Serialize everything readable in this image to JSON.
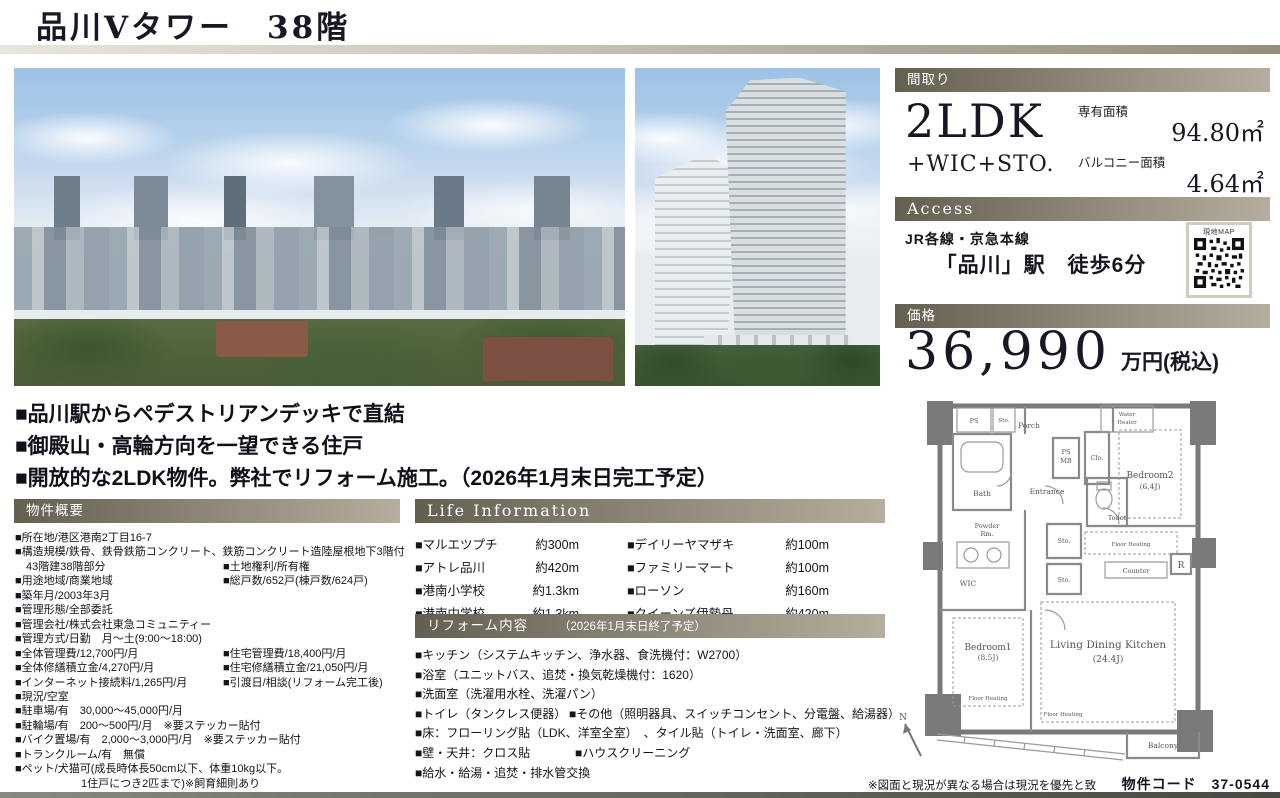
{
  "page": {
    "title": "品川Vタワー　38階",
    "footer_note": "※図面と現況が異なる場合は現況を優先と致します。",
    "property_code": "物件コード　37-0544"
  },
  "colors": {
    "accent_bar_left": "#655f52",
    "accent_bar_right": "#b5ae9f",
    "title_color": "#181824"
  },
  "madori": {
    "header": "間取り",
    "layout": "2LDK",
    "layout_sub": "+WIC+STO.",
    "exclusive_area_label": "専有面積",
    "exclusive_area": "94.80㎡",
    "balcony_area_label": "バルコニー面積",
    "balcony_area": "4.64㎡"
  },
  "access": {
    "header": "Access",
    "rail_lines": "JR各線・京急本線",
    "station": "「品川」駅　徒歩6分",
    "map_label": "現地MAP"
  },
  "price": {
    "header": "価格",
    "amount": "36,990",
    "unit": "万円(税込)"
  },
  "highlights": [
    "■品川駅からペデストリアンデッキで直結",
    "■御殿山・高輪方向を一望できる住戸",
    "■開放的な2LDK物件。弊社でリフォーム施工。（2026年1月末日完工予定）"
  ],
  "overview": {
    "header": "物件概要",
    "rows": [
      {
        "left": "■所在地/港区港南2丁目16-7",
        "right": ""
      },
      {
        "left": "■構造規模/鉄骨、鉄骨鉄筋コンクリート、鉄筋コンクリート造陸屋根地下3階付",
        "right": ""
      },
      {
        "left": "　43階建38階部分",
        "right": "■土地権利/所有権"
      },
      {
        "left": "■用途地域/商業地域",
        "right": "■総戸数/652戸(棟戸数/624戸)"
      },
      {
        "left": "■築年月/2003年3月",
        "right": ""
      },
      {
        "left": "■管理形態/全部委託",
        "right": ""
      },
      {
        "left": "■管理会社/株式会社東急コミュニティー",
        "right": ""
      },
      {
        "left": "■管理方式/日勤　月～土(9:00～18:00)",
        "right": ""
      },
      {
        "left": "■全体管理費/12,700円/月",
        "right": "■住宅管理費/18,400円/月"
      },
      {
        "left": "■全体修繕積立金/4,270円/月",
        "right": "■住宅修繕積立金/21,050円/月"
      },
      {
        "left": "■インターネット接続料/1,265円/月",
        "right": "■引渡日/相談(リフォーム完工後)"
      },
      {
        "left": "■現況/空室",
        "right": ""
      },
      {
        "left": "■駐車場/有　30,000～45,000円/月",
        "right": ""
      },
      {
        "left": "■駐輪場/有　200～500円/月　※要ステッカー貼付",
        "right": ""
      },
      {
        "left": "■バイク置場/有　2,000～3,000円/月　※要ステッカー貼付",
        "right": ""
      },
      {
        "left": "■トランクルーム/有　無償",
        "right": ""
      },
      {
        "left": "■ペット/犬猫可(成長時体長50cm以下、体重10kg以下。",
        "right": ""
      },
      {
        "left": "　　　　　　1住戸につき2匹まで)※飼育細則あり",
        "right": ""
      }
    ]
  },
  "life_info": {
    "header": "Life Information",
    "rows": [
      {
        "name": "■マルエツプチ",
        "dist": "約300m",
        "name2": "■デイリーヤマザキ",
        "dist2": "約100m"
      },
      {
        "name": "■アトレ品川",
        "dist": "約420m",
        "name2": "■ファミリーマート",
        "dist2": "約100m"
      },
      {
        "name": "■港南小学校",
        "dist": "約1.3km",
        "name2": "■ローソン",
        "dist2": "約160m"
      },
      {
        "name": "■港南中学校",
        "dist": "約1.3km",
        "name2": "■クイーンズ伊勢丹",
        "dist2": "約420m"
      }
    ]
  },
  "reform": {
    "header": "リフォーム内容",
    "header_note": "（2026年1月末日終了予定）",
    "rows": [
      {
        "left": "■キッチン（システムキッチン、浄水器、食洗機付：W2700）",
        "right": ""
      },
      {
        "left": "■浴室（ユニットバス、追焚・換気乾燥機付：1620）",
        "right": ""
      },
      {
        "left": "■洗面室（洗濯用水栓、洗濯パン）",
        "right": ""
      },
      {
        "left": "■トイレ（タンクレス便器）",
        "right": "■その他（照明器具、スイッチコンセント、分電盤、給湯器）"
      },
      {
        "left": "■床：フローリング貼（LDK、洋室全室）　、タイル貼（トイレ・洗面室、廊下）",
        "right": ""
      },
      {
        "left": "■壁・天井：クロス貼",
        "right": "■ハウスクリーニング"
      },
      {
        "left": "■給水・給湯・追焚・排水管交換",
        "right": ""
      }
    ]
  },
  "floorplan": {
    "ps": "PS",
    "sto_top": "Sto.",
    "porch": "Porch",
    "ps_mb1": "PS",
    "ps_mb2": "MB",
    "clo": "Clo.",
    "water_heater1": "Water",
    "water_heater2": "Heater",
    "bedroom2": "Bedroom2",
    "bedroom2_size": "(6.4J)",
    "bath": "Bath",
    "entrance": "Entrance",
    "toilet": "Toilet",
    "powder1": "Powder",
    "powder2": "Rm.",
    "sto_mid": "Sto.",
    "sto_low": "Sto.",
    "floor_heating_kitchen": "Floor Heating",
    "counter": "Counter",
    "fridge": "R",
    "wic": "WIC",
    "bedroom1": "Bedroom1",
    "bedroom1_size": "(8.5J)",
    "floor_heating_bed1": "Floor Heating",
    "ldk": "Living Dining Kitchen",
    "ldk_size": "(24.4J)",
    "floor_heating_ldk": "Floor Heating",
    "balcony": "Balcony",
    "compass": "N"
  }
}
